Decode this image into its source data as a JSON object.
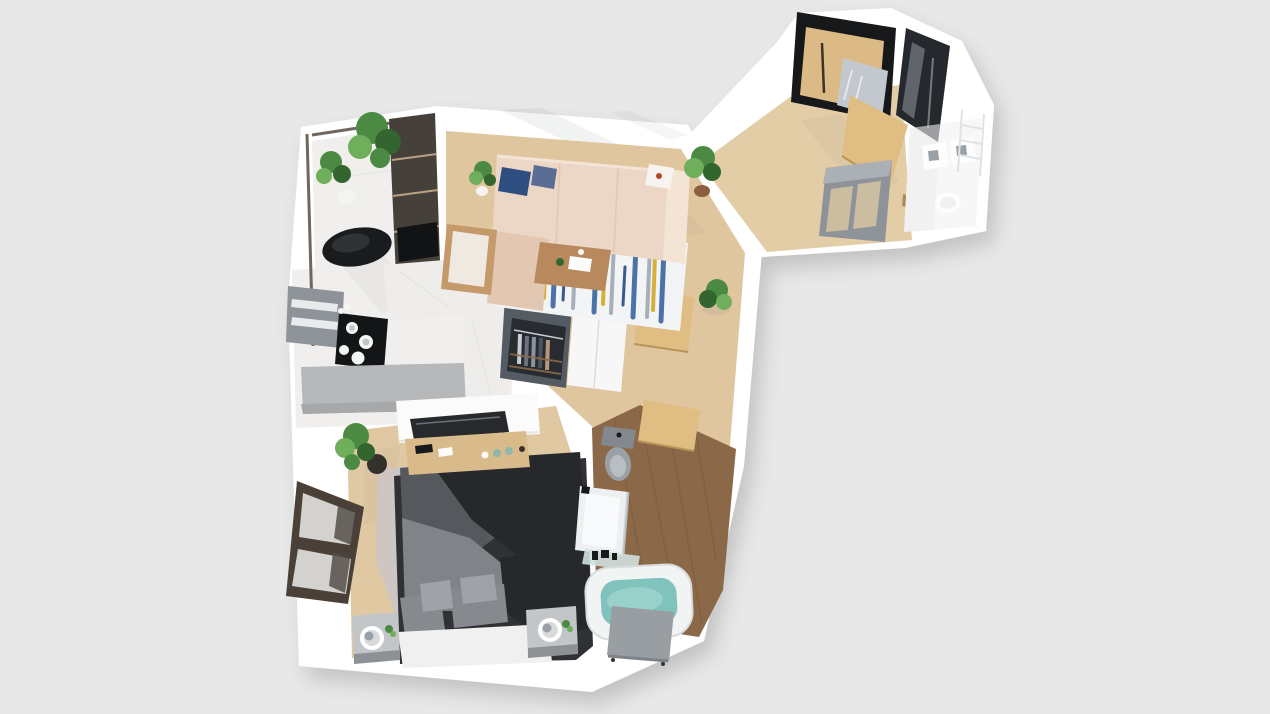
{
  "scene": {
    "kind": "3D rendered top-down apartment floor plan",
    "view": "bird's-eye perspective render"
  },
  "rooms": [
    {
      "name": "balcony",
      "contents": [
        "plants",
        "lounge-chair",
        "shelf-unit"
      ]
    },
    {
      "name": "living-room",
      "contents": [
        "l-shaped-sofa",
        "striped-rug",
        "coffee-table",
        "armchair",
        "potted-plants"
      ]
    },
    {
      "name": "kitchen",
      "contents": [
        "wall-cabinet",
        "cooktop",
        "marble-counter",
        "island"
      ]
    },
    {
      "name": "hallway",
      "contents": [
        "open-closet",
        "wood-doors",
        "potted-plant"
      ]
    },
    {
      "name": "entry",
      "contents": [
        "wardrobe-with-mirror",
        "gloss-cabinet",
        "entry-door",
        "glass-partition"
      ]
    },
    {
      "name": "laundry-bath",
      "contents": [
        "white-fixtures",
        "drying-rack"
      ]
    },
    {
      "name": "bedroom",
      "contents": [
        "double-bed",
        "shag-rug",
        "nightstands",
        "tv",
        "dresser",
        "picture-window",
        "plant"
      ]
    },
    {
      "name": "bathroom",
      "contents": [
        "toilet",
        "shower",
        "bathtub",
        "glass-shelf"
      ]
    }
  ],
  "colors": {
    "background": "#e7e8e7",
    "slab": "#ffffff",
    "wall_shade": "#ededee",
    "shadow_soft": "#8f9091",
    "floor_oak": "#e0c69e",
    "floor_entry": "#e3cda7",
    "floor_bedroom": "#dfc8a2",
    "floor_bath": "#8b6848",
    "floor_bath_line": "#6f5138",
    "floor_marble": "#f0efed",
    "marble_vein": "#d9d9d7",
    "room_floor_white": "#f7f7f7",
    "balcony_rail": "#6f675d",
    "shelf_dark": "#46403a",
    "shelf_line": "#cdb293",
    "shelf_tv": "#121315",
    "chair_black": "#1a1b1d",
    "chair_black_hl": "#3a3d40",
    "plant_green": "#4c8a44",
    "plant_green_dark": "#33652e",
    "plant_green_light": "#6fae5b",
    "pot_white": "#f4f4f2",
    "pot_brown": "#8a5f3e",
    "pot_black": "#34312d",
    "sofa": "#ecd6c5",
    "sofa_shade": "#e2c7b3",
    "sofa_light": "#f4e4d6",
    "pillow_navy": "#2e4d80",
    "pillow_navy2": "#5a6d94",
    "pillow_white": "#f7f4ef",
    "accent_red": "#b8432f",
    "rug_base": "#f3f4f6",
    "rug_blue": "#3a66a0",
    "rug_blue_dark": "#274b86",
    "rug_gray": "#9aa4b1",
    "rug_yellow": "#d3b13c",
    "table_wood": "#b8895c",
    "paper_white": "#fbfbfb",
    "armchair_wood": "#c59a6b",
    "armchair_cushion": "#f0e9e1",
    "cabinet_gray": "#8d9399",
    "cabinet_slat": "#e8eaeb",
    "counter_marble": "#efedeb",
    "island_gray": "#b6b8ba",
    "island_edge": "#a6a8aa",
    "cooktop": "#141517",
    "pot_steel": "#f5f6f6",
    "pot_steel_inner": "#c2c5c7",
    "closet_body": "#545b62",
    "closet_inner": "#282c31",
    "closet_rod": "#c9cdd1",
    "closet_shelf": "#8a6a4a",
    "closet_door": "#f7f7f7",
    "closet_door_seam": "#dcdcdc",
    "clothes": [
      "#c8cdd2",
      "#6b7280",
      "#8a93a0",
      "#4a525c",
      "#b9977a"
    ],
    "door_wood": "#e0bd82",
    "door_wood_edge": "#b99458",
    "threshold_brown": "#b08a5a",
    "wardrobe_frame": "#17181a",
    "wardrobe_wood": "#dcba86",
    "wardrobe_handle": "#3c3324",
    "mirror": "#c2c8ce",
    "mirror_streak": "#eef1f4",
    "gloss_cabinet": "#25282d",
    "gloss_streak": "#9aa1a9",
    "partition_frame": "#8d9399",
    "partition_frame_top": "#aab0b6",
    "partition_glass": "#cfc0a0",
    "fixture_white": "#fdfdfd",
    "fixture_edge": "#e0e0e0",
    "fixture_inset": "#9aa0a6",
    "fixture_inner": "#eef0f1",
    "rack": "#dfe3e6",
    "tv_wall": "#fbfbfb",
    "soft_edge": "#e3e3e3",
    "tv": "#27292d",
    "dresser_wood": "#d9ba8b",
    "jar_teal": "#8fb7ae",
    "window_frame": "#4a4038",
    "window_pane": "#d4d2cf",
    "window_mesh": "#55504a",
    "shag_rug": "#cdc6c2",
    "shag_rug_dark": "#b9b1ad",
    "bed_frame": "#2f3134",
    "duvet": "#55585c",
    "duvet_dark": "#26282b",
    "sheet": "#808489",
    "pillow_gray": "#86898e",
    "pillow_light": "#9fa3a8",
    "mattress": "#f0f0f0",
    "nightstand_top": "#c3c6c9",
    "nightstand_side": "#8e9194",
    "lamp_outer": "#ffffff",
    "lamp_inner": "#d8dadc",
    "lamp_ring": "#9aa0a5",
    "toilet_tank": "#82888d",
    "toilet_bowl": "#9aa0a5",
    "toilet_seat": "#b9bec2",
    "toiletry_black": "#17191c",
    "shower_tray": "#edeff0",
    "shower_inner": "#f9fafb",
    "shower_glass": "#c2ccd2",
    "glass_shelf": "#cfe0de",
    "tub": "#f2f3f3",
    "tub_edge": "#d8dcdd",
    "water": "#7fc3bc",
    "water_light": "#9ed4cd",
    "tub_panel": "#999ea3",
    "tub_panel_dark": "#7d8287"
  }
}
